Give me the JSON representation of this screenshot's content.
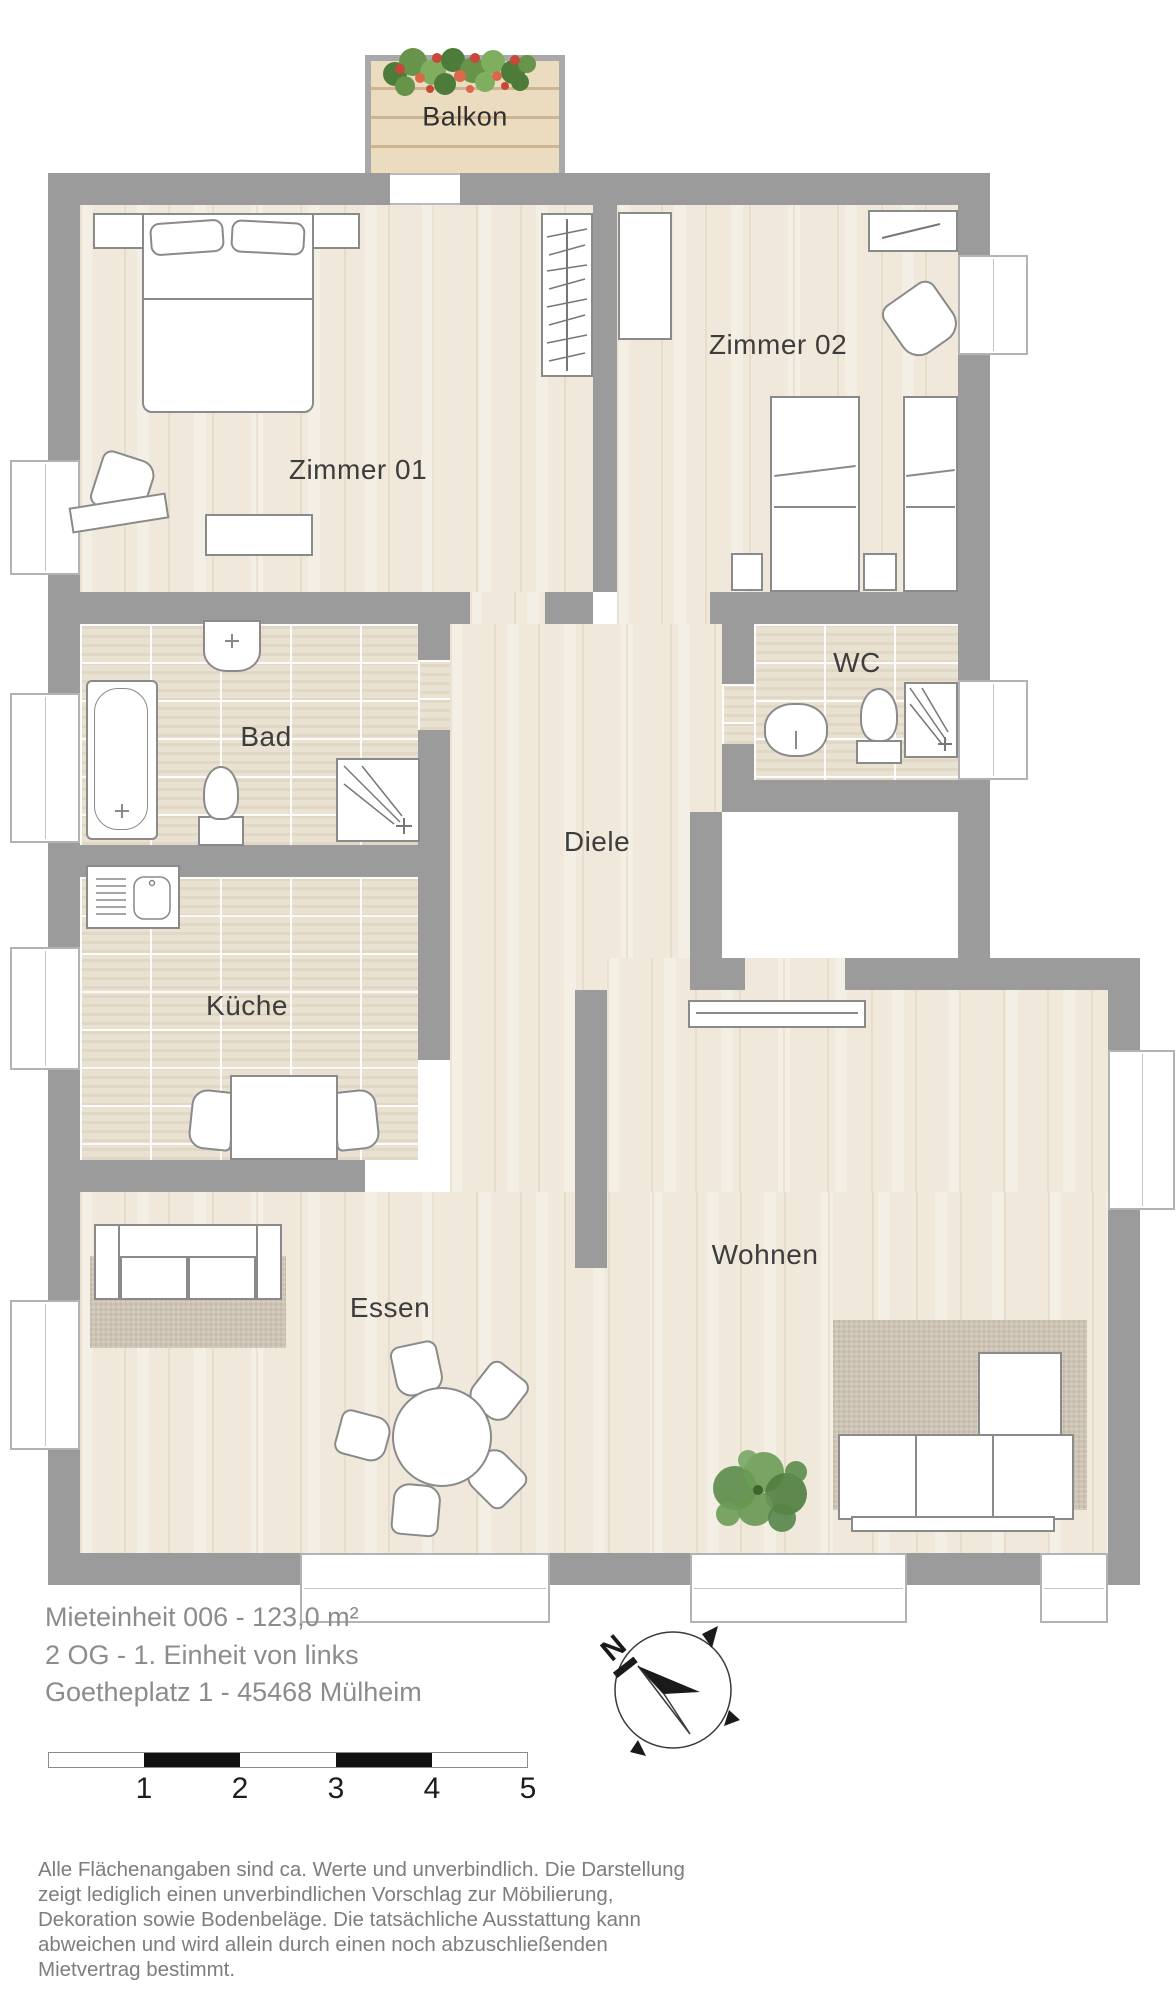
{
  "rooms": {
    "balkon": "Balkon",
    "zimmer01": "Zimmer 01",
    "zimmer02": "Zimmer 02",
    "bad": "Bad",
    "wc": "WC",
    "diele": "Diele",
    "kueche": "Küche",
    "essen": "Essen",
    "wohnen": "Wohnen"
  },
  "title_block": {
    "line1": "Mieteinheit 006 - 123,0 m²",
    "line2": "2 OG - 1. Einheit von links",
    "line3": "Goetheplatz 1 - 45468 Mülheim"
  },
  "compass": {
    "north": "N"
  },
  "scale_bar": {
    "labels": [
      "1",
      "2",
      "3",
      "4",
      "5"
    ]
  },
  "disclaimer": {
    "lines": [
      "Alle Flächenangaben sind ca. Werte und unverbindlich. Die Darstellung",
      "zeigt lediglich einen unverbindlichen Vorschlag zur Möbilierung,",
      "Dekoration sowie Bodenbeläge. Die tatsächliche  Ausstattung kann",
      "abweichen und wird allein durch einen noch abzuschließenden",
      "Mietvertrag bestimmt."
    ]
  },
  "colors": {
    "wall": "#9b9b9b",
    "wood_floor": "#f0e8da",
    "tile_floor": "#e9e1d1",
    "rug": "#cdc3b4",
    "room_label": "#3d3d3d",
    "info_text": "#8c8c8c",
    "plant_green": "#5b8c4a",
    "flower_red": "#c8473a"
  }
}
